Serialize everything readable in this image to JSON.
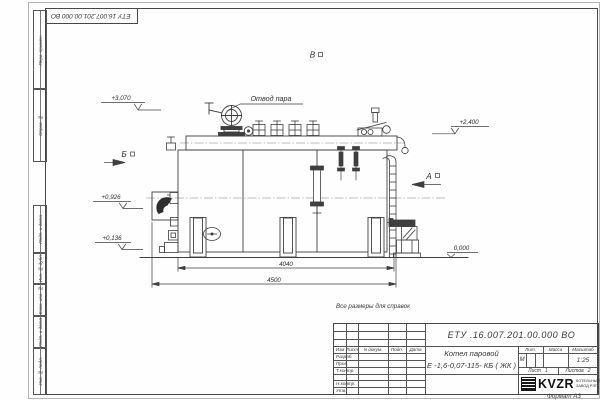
{
  "page": {
    "designation_flipped": "ЕТУ 16.007.201.00.000  ВО",
    "note": "Все размеры для справок",
    "format": "Формат  А3",
    "ink_color": "#3f3f3f",
    "paper_color": "#fefefe"
  },
  "margin": {
    "stamp_top": [
      "Перв. примен.",
      "Справ. №"
    ],
    "stamp_bottom": [
      "Подп. и дата",
      "Инв. № дубл.",
      "Взам. инв. №",
      "Подп. и дата",
      "Инв. № подл."
    ]
  },
  "drawing": {
    "callout_steam_outlet": "Отвод пара",
    "views": {
      "view_b": "Б",
      "view_a": "А",
      "view_v": "В"
    },
    "elevations": {
      "e3070": "+3,070",
      "e2400": "+2,400",
      "e0926": "+0,926",
      "e0136": "+0,136",
      "e0000": "0,000"
    },
    "dimensions": {
      "inner": "4040",
      "overall": "4500"
    }
  },
  "title_block": {
    "designation": "ЕТУ .16.007.201.00.000  ВО",
    "product_name_1": "Котел паровой",
    "product_name_2": "Е -1,6-0,07-115- КБ ( ЖК )",
    "col_headers": {
      "izm": "Изм",
      "list": "Лист",
      "doc": "N докум.",
      "podp": "Подп.",
      "data": "Дата"
    },
    "rows": {
      "razrab": "Разраб.",
      "prov": "Пров.",
      "tkontr": "Т.контр.",
      "nkontr": "Н.контр.",
      "utv": "Утв."
    },
    "props": {
      "lit_label": "Лит.",
      "mass_label": "Масса",
      "scale_label": "Масштаб",
      "lit_value": "М",
      "scale_value": "1:25"
    },
    "sheets": {
      "list_label": "Лист",
      "list_value": "1",
      "listov_label": "Листов",
      "listov_value": "2"
    },
    "logo": {
      "name": "KVZR",
      "caption1": "КОТЕЛЬНЫЙ",
      "caption2": "ЗАВОД РЭП"
    }
  }
}
